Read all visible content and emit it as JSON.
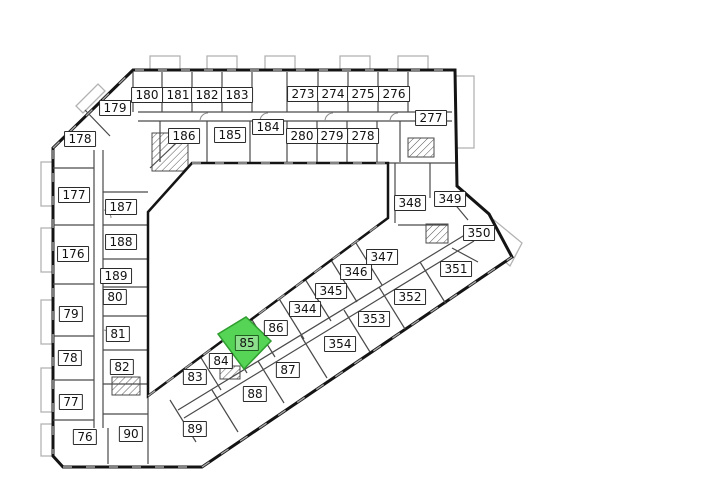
{
  "plan": {
    "selected_unit": "85",
    "highlight": {
      "fill": "#55d455",
      "stroke": "#2f9e2f",
      "label_fill": "#8ce08c"
    },
    "colors": {
      "wall": "#141414",
      "thin_wall": "#4a4a4a",
      "balcony": "#b3b3b3",
      "background": "#ffffff"
    },
    "units": [
      {
        "id": "76",
        "x": 85,
        "y": 437
      },
      {
        "id": "77",
        "x": 71,
        "y": 402
      },
      {
        "id": "78",
        "x": 70,
        "y": 358
      },
      {
        "id": "79",
        "x": 71,
        "y": 314
      },
      {
        "id": "80",
        "x": 115,
        "y": 297
      },
      {
        "id": "81",
        "x": 118,
        "y": 334
      },
      {
        "id": "82",
        "x": 122,
        "y": 367
      },
      {
        "id": "83",
        "x": 195,
        "y": 377
      },
      {
        "id": "84",
        "x": 221,
        "y": 361
      },
      {
        "id": "85",
        "x": 247,
        "y": 343
      },
      {
        "id": "86",
        "x": 276,
        "y": 328
      },
      {
        "id": "87",
        "x": 288,
        "y": 370
      },
      {
        "id": "88",
        "x": 255,
        "y": 394
      },
      {
        "id": "89",
        "x": 195,
        "y": 429
      },
      {
        "id": "90",
        "x": 131,
        "y": 434
      },
      {
        "id": "176",
        "x": 73,
        "y": 254
      },
      {
        "id": "177",
        "x": 74,
        "y": 195
      },
      {
        "id": "178",
        "x": 80,
        "y": 139
      },
      {
        "id": "179",
        "x": 115,
        "y": 108
      },
      {
        "id": "180",
        "x": 147,
        "y": 95
      },
      {
        "id": "181",
        "x": 178,
        "y": 95
      },
      {
        "id": "182",
        "x": 207,
        "y": 95
      },
      {
        "id": "183",
        "x": 237,
        "y": 95
      },
      {
        "id": "184",
        "x": 268,
        "y": 127
      },
      {
        "id": "185",
        "x": 230,
        "y": 135
      },
      {
        "id": "186",
        "x": 184,
        "y": 136
      },
      {
        "id": "187",
        "x": 121,
        "y": 207
      },
      {
        "id": "188",
        "x": 121,
        "y": 242
      },
      {
        "id": "189",
        "x": 116,
        "y": 276
      },
      {
        "id": "273",
        "x": 303,
        "y": 94
      },
      {
        "id": "274",
        "x": 333,
        "y": 94
      },
      {
        "id": "275",
        "x": 363,
        "y": 94
      },
      {
        "id": "276",
        "x": 394,
        "y": 94
      },
      {
        "id": "277",
        "x": 431,
        "y": 118
      },
      {
        "id": "278",
        "x": 363,
        "y": 136
      },
      {
        "id": "279",
        "x": 332,
        "y": 136
      },
      {
        "id": "280",
        "x": 302,
        "y": 136
      },
      {
        "id": "344",
        "x": 305,
        "y": 309
      },
      {
        "id": "345",
        "x": 331,
        "y": 291
      },
      {
        "id": "346",
        "x": 356,
        "y": 272
      },
      {
        "id": "347",
        "x": 382,
        "y": 257
      },
      {
        "id": "348",
        "x": 410,
        "y": 203
      },
      {
        "id": "349",
        "x": 450,
        "y": 199
      },
      {
        "id": "350",
        "x": 479,
        "y": 233
      },
      {
        "id": "351",
        "x": 456,
        "y": 269
      },
      {
        "id": "352",
        "x": 410,
        "y": 297
      },
      {
        "id": "353",
        "x": 374,
        "y": 319
      },
      {
        "id": "354",
        "x": 340,
        "y": 344
      }
    ]
  }
}
